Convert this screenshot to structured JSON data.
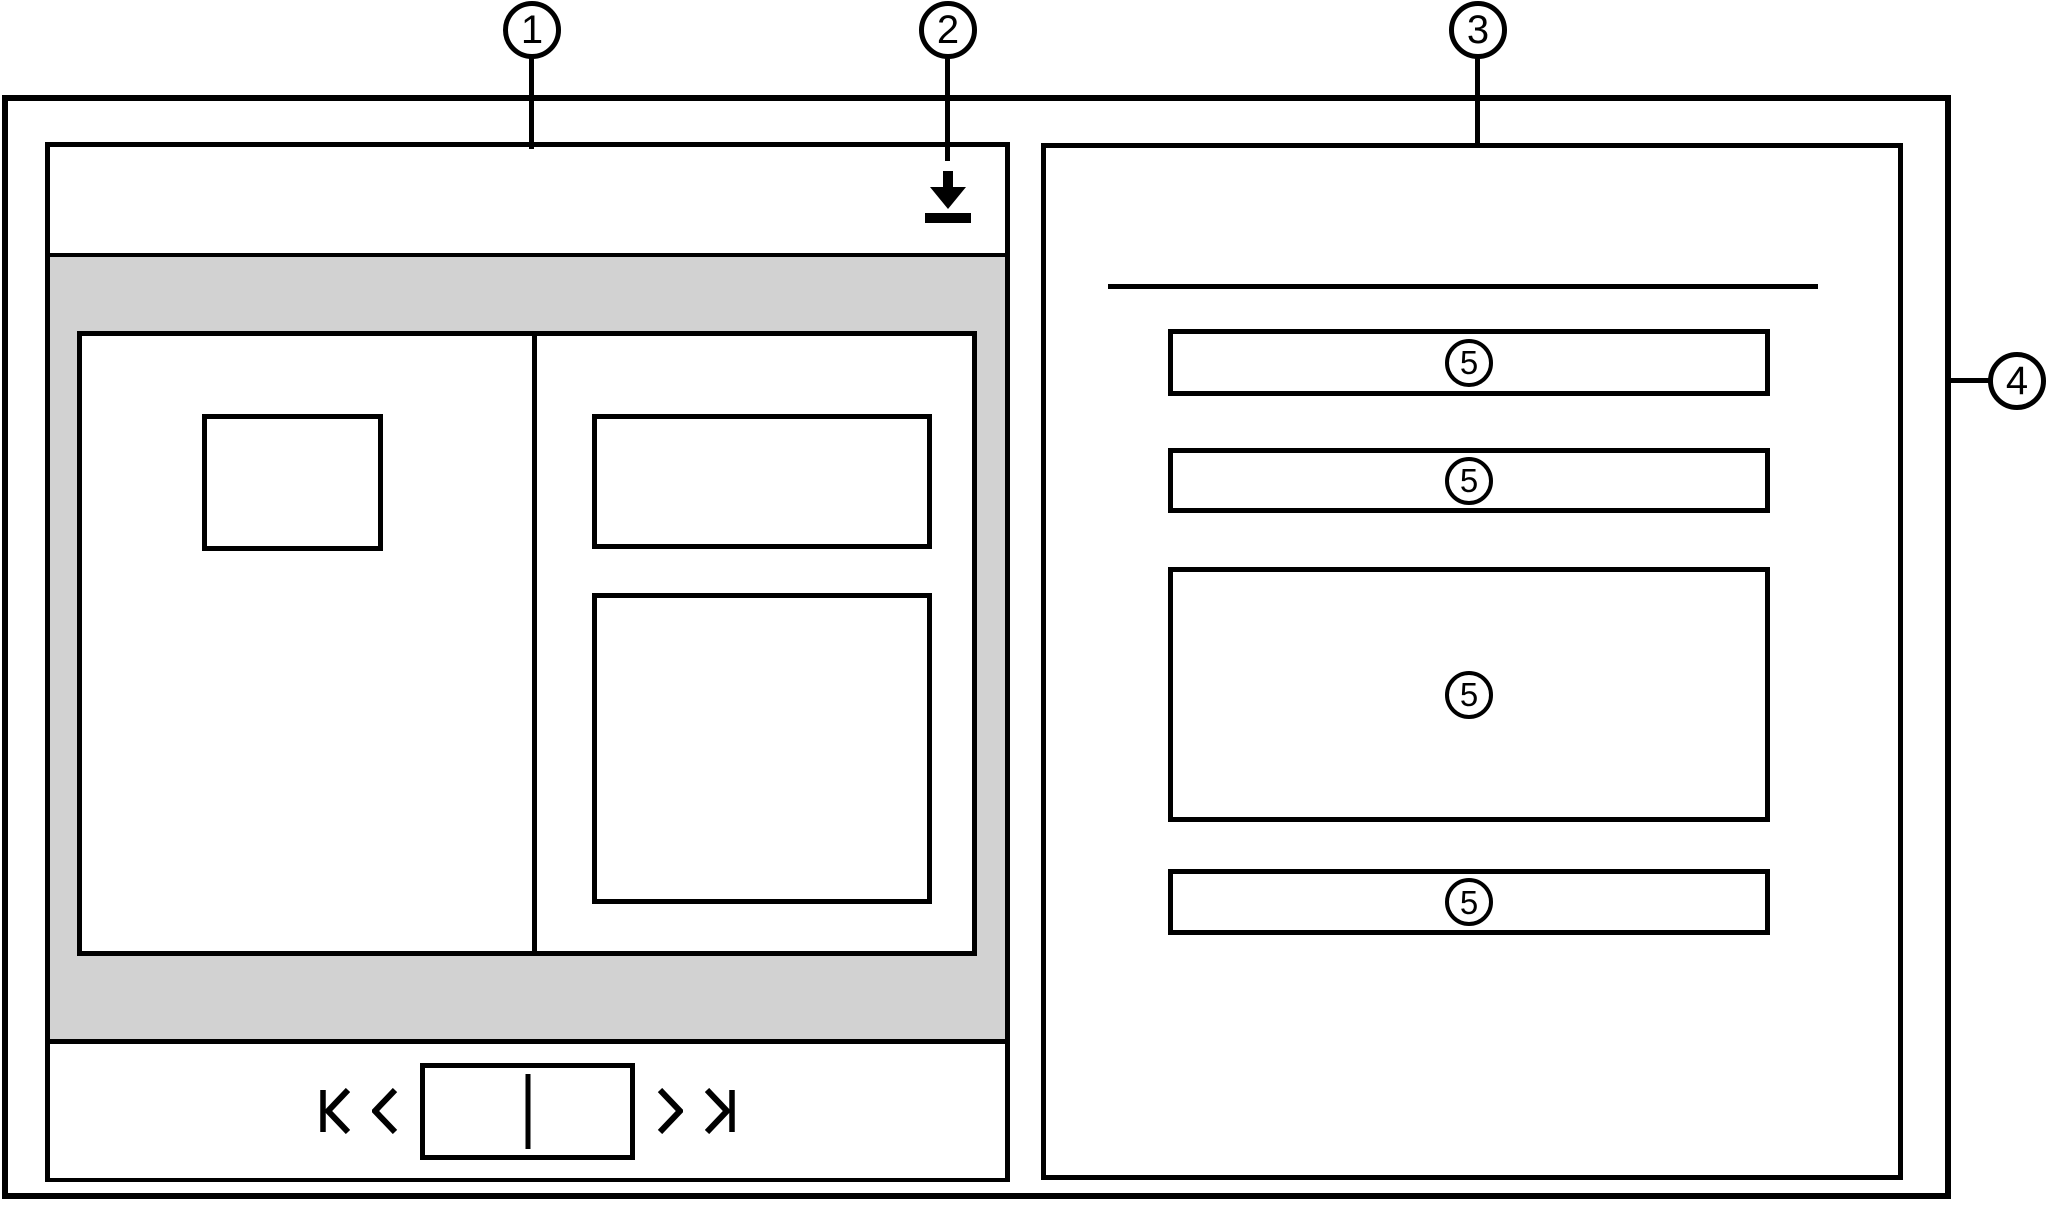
{
  "figure": {
    "type": "wireframe",
    "colors": {
      "stroke": "#000000",
      "surface": "#ffffff",
      "content_backdrop": "#d2d2d2"
    }
  },
  "callouts": {
    "c1": "1",
    "c2": "2",
    "c3": "3",
    "c4": "4",
    "c5": "5"
  },
  "icons": {
    "download": "download-icon",
    "first_page": "first-page-icon",
    "previous_page": "previous-page-icon",
    "page_spread_indicator": "page-spread-indicator",
    "next_page": "next-page-icon",
    "last_page": "last-page-icon"
  }
}
